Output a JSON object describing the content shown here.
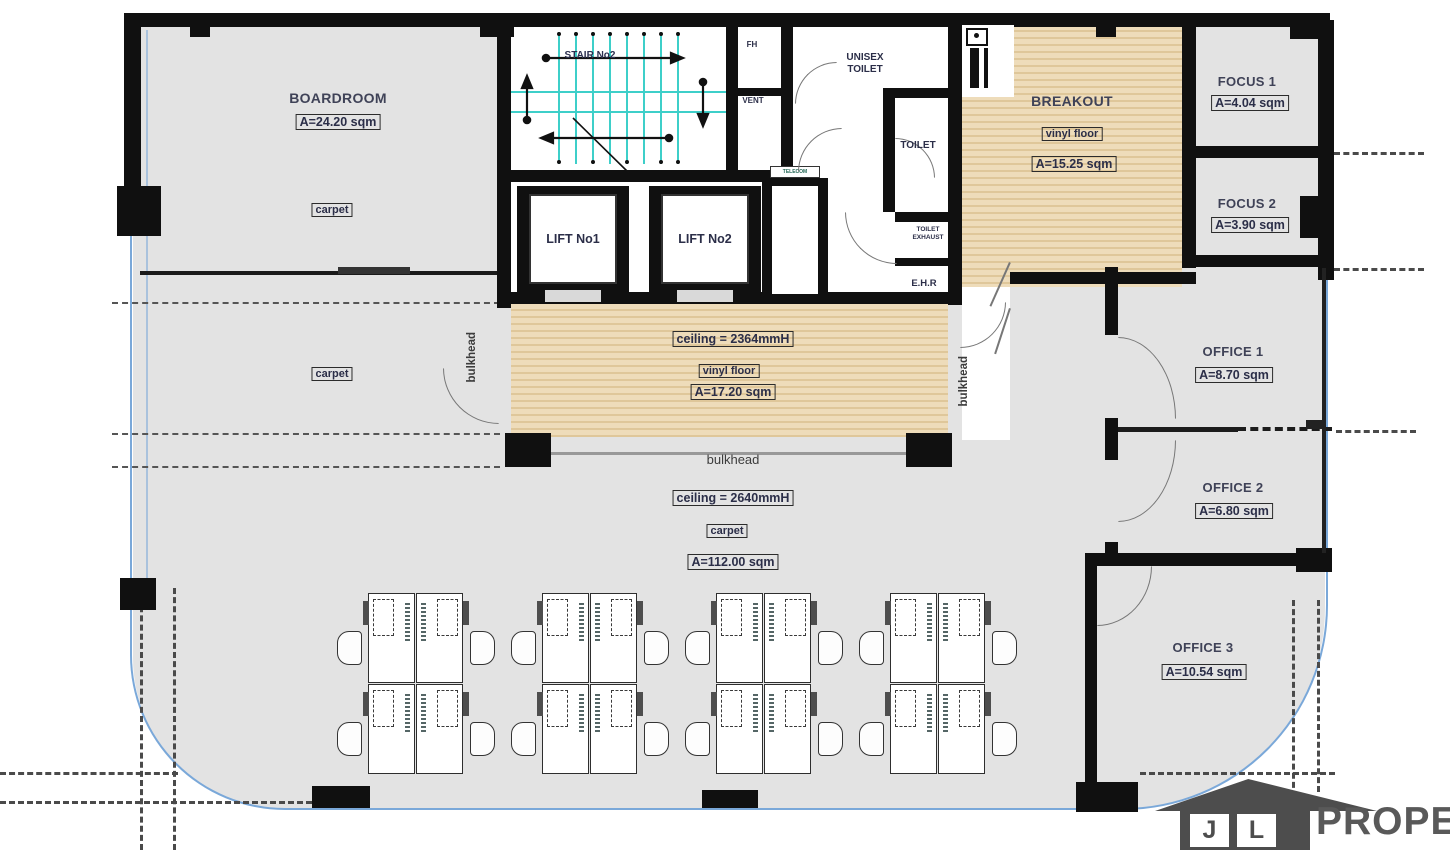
{
  "rooms": {
    "boardroom": {
      "name": "BOARDROOM",
      "area": "A=24.20 sqm",
      "floor": "carpet"
    },
    "carpet_zone": {
      "floor": "carpet"
    },
    "stair": {
      "name": "STAIR No2"
    },
    "fh": {
      "name": "FH"
    },
    "vent": {
      "name": "VENT"
    },
    "unisex_toilet": {
      "name": "UNISEX TOILET"
    },
    "toilet": {
      "name": "TOILET"
    },
    "toilet_exhaust": {
      "name": "TOILET EXHAUST"
    },
    "ehr": {
      "name": "E.H.R"
    },
    "telecom": {
      "name": "TELECOM"
    },
    "lift1": {
      "name": "LIFT No1"
    },
    "lift2": {
      "name": "LIFT No2"
    },
    "breakout": {
      "name": "BREAKOUT",
      "floor": "vinyl floor",
      "area": "A=15.25 sqm"
    },
    "focus1": {
      "name": "FOCUS 1",
      "area": "A=4.04 sqm"
    },
    "focus2": {
      "name": "FOCUS 2",
      "area": "A=3.90 sqm"
    },
    "office1": {
      "name": "OFFICE 1",
      "area": "A=8.70 sqm"
    },
    "office2": {
      "name": "OFFICE 2",
      "area": "A=6.80 sqm"
    },
    "office3": {
      "name": "OFFICE 3",
      "area": "A=10.54 sqm"
    },
    "reception": {
      "ceiling": "ceiling = 2364mmH",
      "floor": "vinyl floor",
      "area": "A=17.20 sqm"
    },
    "open_office": {
      "ceiling": "ceiling = 2640mmH",
      "floor": "carpet",
      "area": "A=112.00 sqm"
    }
  },
  "annotations": {
    "bulkhead": "bulkhead"
  },
  "branding": {
    "initial_1": "J",
    "initial_2": "L",
    "logo_text": "PROPERTY"
  },
  "colors": {
    "wall": "#101010",
    "floor": "#e3e3e3",
    "wood": "#eedcba",
    "stair": "#3ecfc9",
    "glass": "#7aa8d9",
    "label": "#3f4257"
  }
}
